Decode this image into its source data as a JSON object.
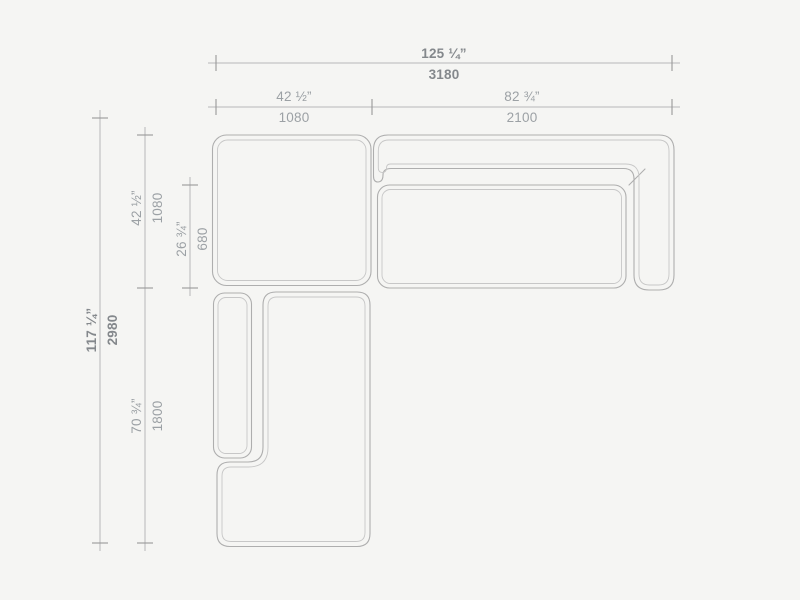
{
  "drawing": {
    "type": "sectional-sofa-top-view-dimension-drawing",
    "dimensions": {
      "overall_width": {
        "inches": "125 ¼”",
        "mm": "3180"
      },
      "left_module_width": {
        "inches": "42 ½”",
        "mm": "1080"
      },
      "right_module_width": {
        "inches": "82 ¾”",
        "mm": "2100"
      },
      "overall_depth": {
        "inches": "117 ¼”",
        "mm": "2980"
      },
      "top_module_depth": {
        "inches": "42 ½”",
        "mm": "1080"
      },
      "seat_depth": {
        "inches": "26 ¾”",
        "mm": "680"
      },
      "chaise_length": {
        "inches": "70 ¾”",
        "mm": "1800"
      }
    },
    "colors": {
      "background": "#f5f5f3",
      "line_outer": "#aeaeae",
      "line_inner": "#c7c7c7",
      "dim_line": "#b8b8b8",
      "tick": "#989898",
      "text_primary": "#84888c",
      "text_secondary": "#9ca1a5"
    }
  }
}
